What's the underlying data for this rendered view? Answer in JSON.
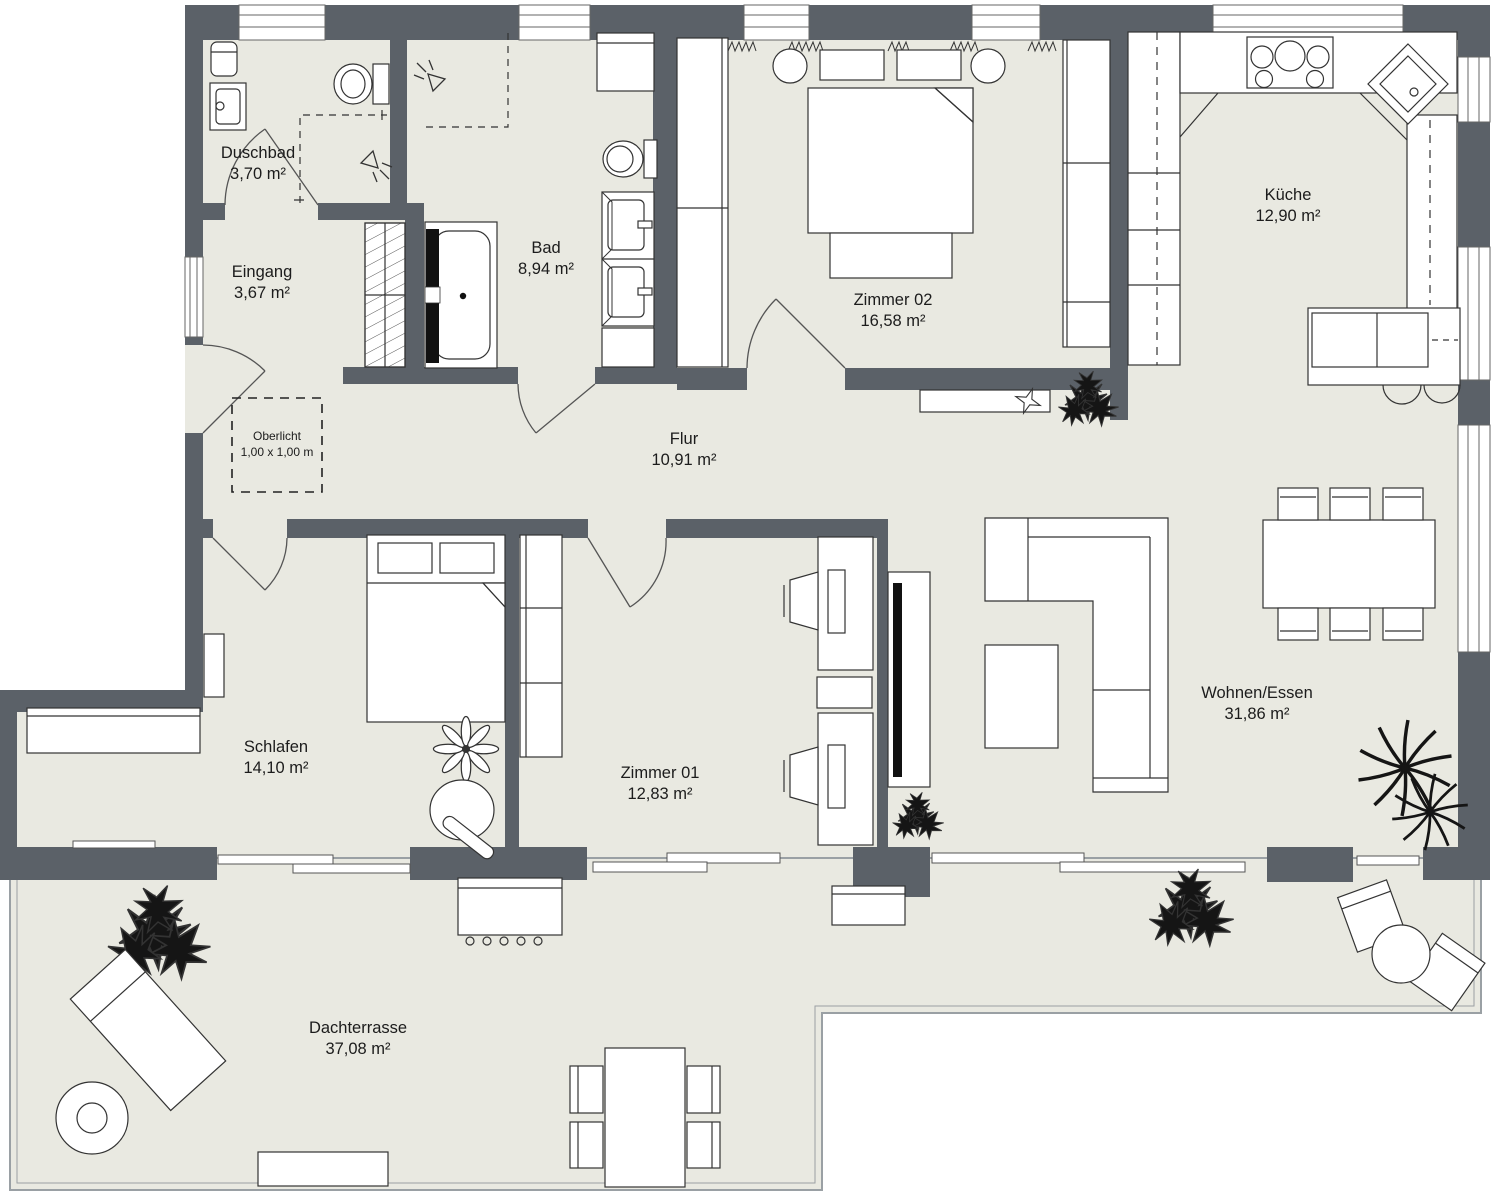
{
  "plan": {
    "type": "floor-plan",
    "rooms": [
      {
        "id": "duschbad",
        "name": "Duschbad",
        "area": "3,70 m²"
      },
      {
        "id": "eingang",
        "name": "Eingang",
        "area": "3,67 m²"
      },
      {
        "id": "bad",
        "name": "Bad",
        "area": "8,94 m²"
      },
      {
        "id": "zimmer02",
        "name": "Zimmer 02",
        "area": "16,58 m²"
      },
      {
        "id": "kueche",
        "name": "Küche",
        "area": "12,90 m²"
      },
      {
        "id": "flur",
        "name": "Flur",
        "area": "10,91 m²"
      },
      {
        "id": "schlafen",
        "name": "Schlafen",
        "area": "14,10 m²"
      },
      {
        "id": "zimmer01",
        "name": "Zimmer 01",
        "area": "12,83 m²"
      },
      {
        "id": "wohnen_essen",
        "name": "Wohnen/Essen",
        "area": "31,86 m²"
      },
      {
        "id": "dachterrasse",
        "name": "Dachterrasse",
        "area": "37,08 m²"
      }
    ],
    "skylight": {
      "label": "Oberlicht",
      "size": "1,00 x 1,00 m"
    },
    "colors": {
      "wall": "#5b6168",
      "floor": "#e9e9e1",
      "furniture_fill": "#ffffff",
      "line": "#333333",
      "dark_fixture": "#111111",
      "background": "#ffffff"
    }
  }
}
